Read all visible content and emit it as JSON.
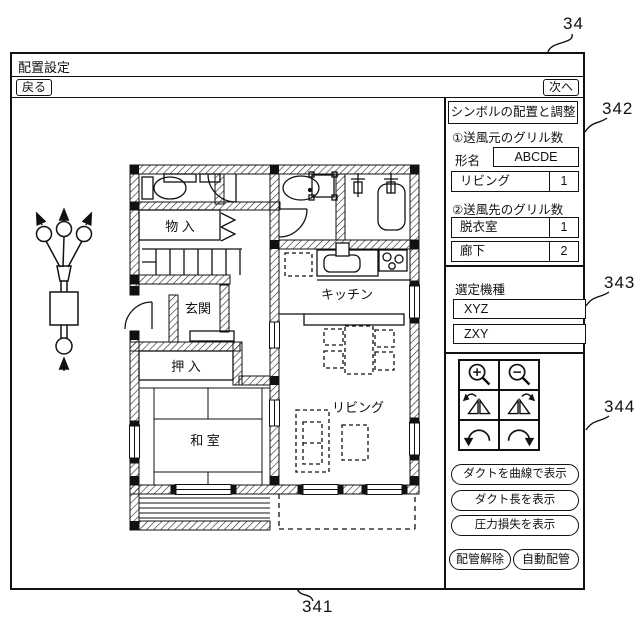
{
  "ref_labels": {
    "window": "34",
    "floorplan": "330",
    "duct_symbol": "130",
    "canvas": "341",
    "panel_grills": "342",
    "panel_models": "343",
    "panel_tools": "344"
  },
  "window": {
    "title": "配置設定",
    "back_label": "戻る",
    "next_label": "次へ"
  },
  "sidebar": {
    "header": "シンボルの配置と調整",
    "grills": {
      "source_title": "①送風元のグリル数",
      "model_label": "形名",
      "model_value": "ABCDE",
      "source_rows": [
        {
          "room": "リビング",
          "count": "1"
        }
      ],
      "dest_title": "②送風先のグリル数",
      "dest_rows": [
        {
          "room": "脱衣室",
          "count": "1"
        },
        {
          "room": "廊下",
          "count": "2"
        }
      ]
    },
    "models": {
      "title": "選定機種",
      "options": [
        "XYZ",
        "ZXY"
      ]
    },
    "tools": {
      "icons": [
        "zoom-in",
        "zoom-out",
        "flip-horizontal-ccw",
        "flip-horizontal-cw",
        "rotate-ccw",
        "rotate-cw"
      ],
      "buttons": [
        "ダクトを曲線で表示",
        "ダクト長を表示",
        "圧力損失を表示"
      ],
      "small_buttons": [
        "配管解除",
        "自動配管"
      ]
    }
  },
  "floorplan": {
    "rooms": {
      "storage": "物 入",
      "entrance": "玄関",
      "closet": "押 入",
      "japanese_room": "和 室",
      "kitchen": "キッチン",
      "living": "リビング"
    }
  },
  "colors": {
    "line": "#111111",
    "background": "#ffffff"
  }
}
